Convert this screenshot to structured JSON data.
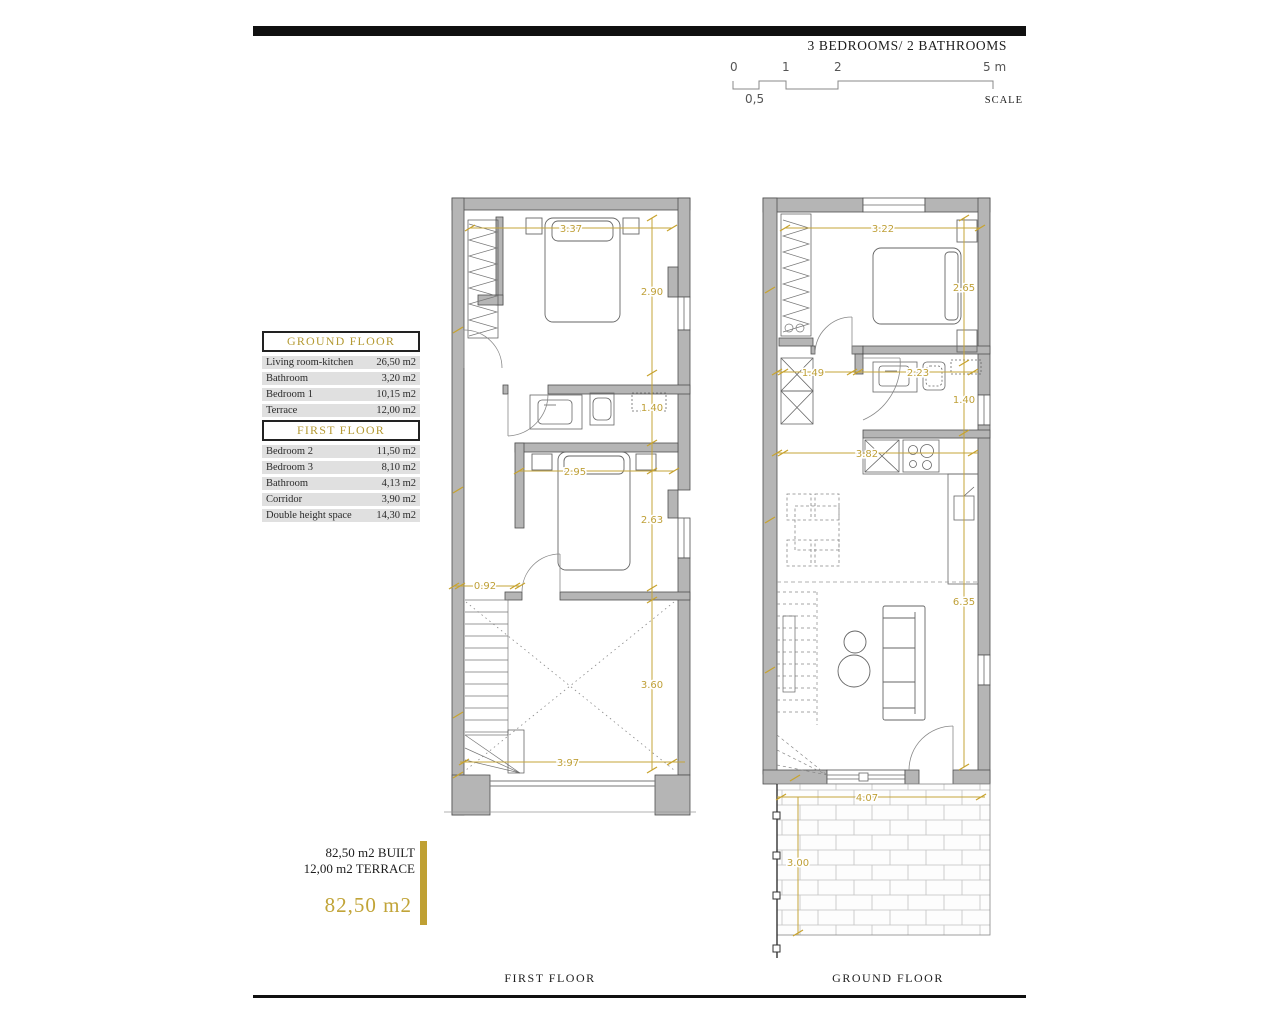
{
  "header": {
    "subtitle": "3 BEDROOMS/ 2 BATHROOMS"
  },
  "scalebar": {
    "tick0": "0",
    "tick1": "1",
    "tick2": "2",
    "tick5": "5 m",
    "half": "0,5",
    "label": "SCALE"
  },
  "tables": {
    "ground_floor": {
      "title": "GROUND FLOOR",
      "rows": [
        {
          "label": "Living room-kitchen",
          "value": "26,50 m2"
        },
        {
          "label": "Bathroom",
          "value": "3,20 m2"
        },
        {
          "label": "Bedroom 1",
          "value": "10,15 m2"
        },
        {
          "label": "Terrace",
          "value": "12,00 m2"
        }
      ]
    },
    "first_floor": {
      "title": "FIRST FLOOR",
      "rows": [
        {
          "label": "Bedroom 2",
          "value": "11,50 m2"
        },
        {
          "label": "Bedroom 3",
          "value": "8,10 m2"
        },
        {
          "label": "Bathroom",
          "value": "4,13 m2"
        },
        {
          "label": "Corridor",
          "value": "3,90 m2"
        },
        {
          "label": "Double height space",
          "value": "14,30 m2"
        }
      ]
    }
  },
  "summary": {
    "built": "82,50 m2 BUILT",
    "terrace": "12,00 m2 TERRACE",
    "total": "82,50 m2"
  },
  "plans": {
    "first_floor": {
      "caption": "FIRST FLOOR",
      "dims": {
        "top_width": "3.37",
        "bedroom2_height": "2.90",
        "bathroom_height": "1.40",
        "bedroom3_width": "2.95",
        "bedroom3_height": "2.63",
        "stair_width": "0.92",
        "void_height": "3.60",
        "bottom_width": "3.97"
      }
    },
    "ground_floor": {
      "caption": "GROUND FLOOR",
      "dims": {
        "top_width": "3.22",
        "bedroom1_height": "2.65",
        "hall_width": "1.49",
        "bathroom_width": "2.23",
        "bathroom_height": "1.40",
        "kitchen_width": "3.82",
        "living_height": "6.35",
        "terrace_width": "4.07",
        "terrace_height": "3.00"
      }
    }
  },
  "colors": {
    "accent": "#bfa038",
    "wall_fill": "#b5b5b5",
    "wall_stroke": "#4f4f4f",
    "row_bg": "#e0e0e0",
    "bar_black": "#101010"
  }
}
